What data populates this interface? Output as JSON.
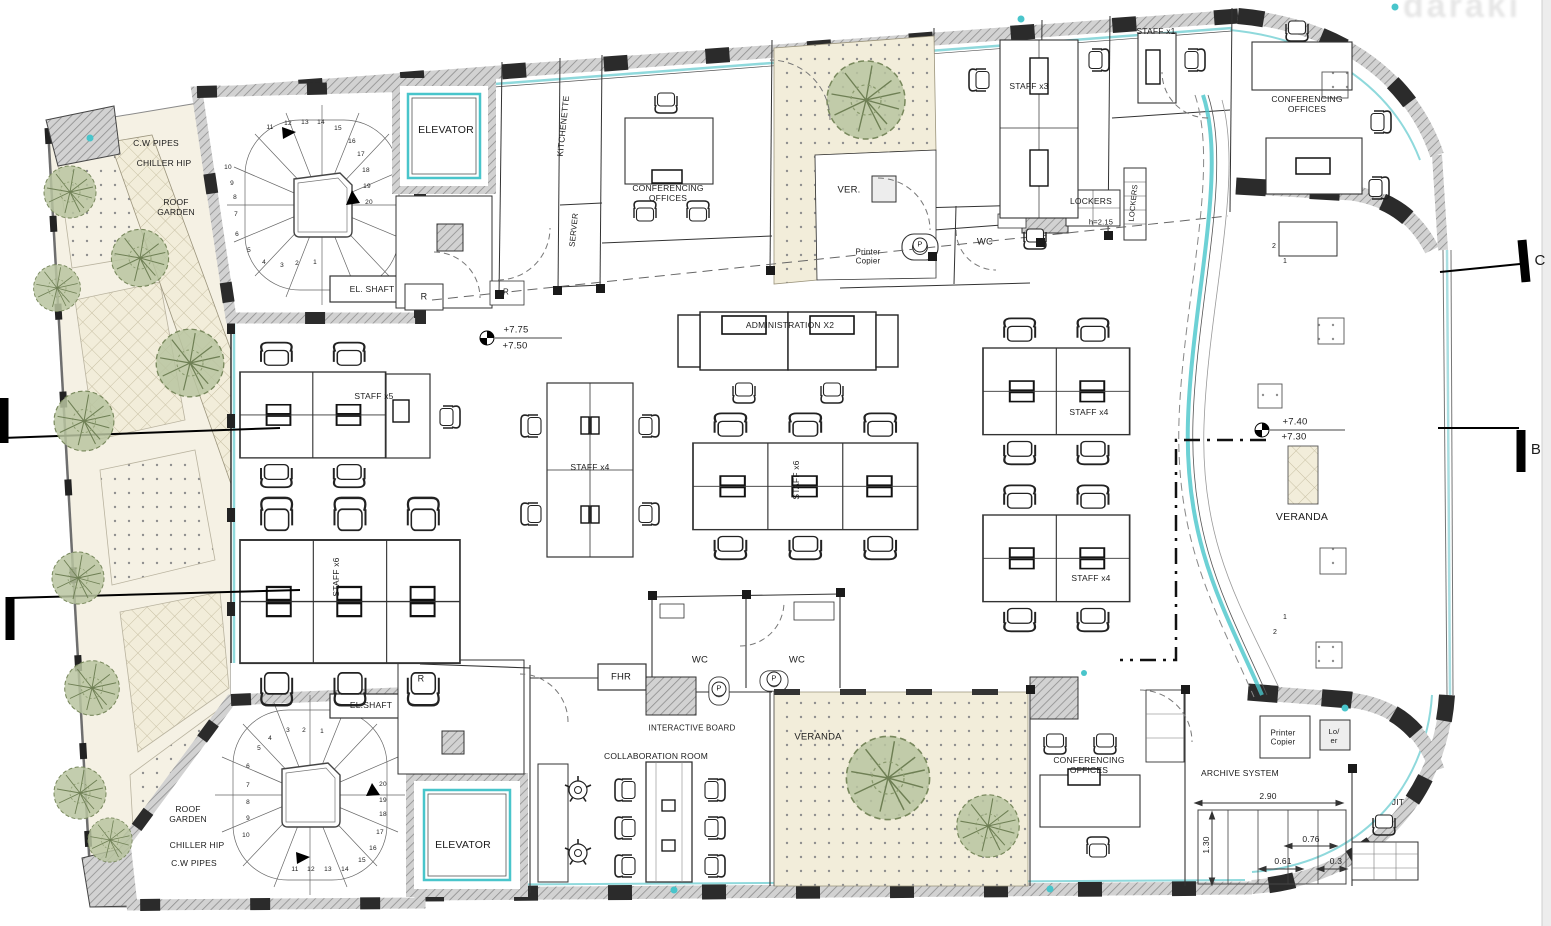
{
  "drawing": {
    "type": "office-floor-plan",
    "section_markers": [
      "C",
      "B"
    ],
    "stair_step_count": 20,
    "colors": {
      "wall_gray": "#d2d2d2",
      "hatch_line": "#8e8e8e",
      "line_black": "#2a2a2a",
      "glazing_cyan": "#8fd9dc",
      "accent_teal": "#49c5cb",
      "tree_green": "#b9c4a0",
      "garden_cream": "#f2edda"
    },
    "watermark_fragment": "daraki"
  },
  "labels": [
    {
      "name": "cw-pipes-top-label",
      "text": "C.W PIPES",
      "x": 156,
      "y": 143,
      "fs": 8.5
    },
    {
      "name": "chiller-hip-top-label",
      "text": "CHILLER HIP",
      "x": 164,
      "y": 163,
      "fs": 8.5
    },
    {
      "name": "roof-garden-top-label",
      "text": "ROOF\nGARDEN",
      "x": 176,
      "y": 207,
      "fs": 8.5
    },
    {
      "name": "el-shaft-top-label",
      "text": "EL. SHAFT",
      "x": 372,
      "y": 289,
      "fs": 8.5
    },
    {
      "name": "r-closet-top-1-label",
      "text": "R",
      "x": 424,
      "y": 297,
      "fs": 9
    },
    {
      "name": "r-closet-top-2-label",
      "text": "R",
      "x": 506,
      "y": 292,
      "fs": 8
    },
    {
      "name": "elevator-top-label",
      "text": "ELEVATOR",
      "x": 446,
      "y": 130,
      "fs": 10.5
    },
    {
      "name": "kitchenette-label",
      "text": "KITCHENETTE",
      "x": 563,
      "y": 126,
      "fs": 8.5,
      "rot": -84
    },
    {
      "name": "server-label",
      "text": "SERVER",
      "x": 574,
      "y": 230,
      "fs": 8,
      "rot": -84
    },
    {
      "name": "conferencing-offices-top-label",
      "text": "CONFERENCING\nOFFICES",
      "x": 668,
      "y": 193,
      "fs": 8.5
    },
    {
      "name": "ver-label",
      "text": "VER.",
      "x": 849,
      "y": 190,
      "fs": 9.5
    },
    {
      "name": "printer-copier-top-label",
      "text": "Printer\nCopier",
      "x": 868,
      "y": 257,
      "fs": 8
    },
    {
      "name": "printer-p-top-label",
      "text": "P",
      "x": 920,
      "y": 245,
      "fs": 7.5,
      "cls": "circ"
    },
    {
      "name": "wc-top-label",
      "text": "WC",
      "x": 985,
      "y": 242,
      "fs": 9.5
    },
    {
      "name": "staff-x3-label",
      "text": "STAFF x3",
      "x": 1029,
      "y": 86,
      "fs": 8.5
    },
    {
      "name": "lockers-label",
      "text": "LOCKERS",
      "x": 1091,
      "y": 201,
      "fs": 8.5
    },
    {
      "name": "lockers-height-label",
      "text": "h=2.15",
      "x": 1101,
      "y": 223,
      "fs": 7.5
    },
    {
      "name": "lockers-vertical-label",
      "text": "LOCKERS",
      "x": 1134,
      "y": 203,
      "fs": 7.5,
      "rot": -84
    },
    {
      "name": "staff-x1-label",
      "text": "STAFF x1",
      "x": 1156,
      "y": 31,
      "fs": 8.5
    },
    {
      "name": "conferencing-offices-topright-label",
      "text": "CONFERENCING\nOFFICES",
      "x": 1307,
      "y": 104,
      "fs": 8.5
    },
    {
      "name": "level-775-label",
      "text": "+7.75",
      "x": 516,
      "y": 330,
      "fs": 9.5
    },
    {
      "name": "level-750-label",
      "text": "+7.50",
      "x": 515,
      "y": 346,
      "fs": 9.5
    },
    {
      "name": "administration-x2-label",
      "text": "ADMINISTRATION X2",
      "x": 790,
      "y": 325,
      "fs": 8.5
    },
    {
      "name": "staff-x5-label",
      "text": "STAFF x5",
      "x": 374,
      "y": 396,
      "fs": 8.5
    },
    {
      "name": "staff-x4-centerleft-label",
      "text": "STAFF x4",
      "x": 590,
      "y": 467,
      "fs": 8.5
    },
    {
      "name": "staff-x6-left-label",
      "text": "STAFF x6",
      "x": 336,
      "y": 577,
      "fs": 8.5,
      "rot": -90
    },
    {
      "name": "staff-x6-center-label",
      "text": "STAFF x6",
      "x": 796,
      "y": 480,
      "fs": 8.5,
      "rot": -90
    },
    {
      "name": "staff-x4-right-upper-label",
      "text": "STAFF x4",
      "x": 1089,
      "y": 412,
      "fs": 8.5
    },
    {
      "name": "staff-x4-right-lower-label",
      "text": "STAFF x4",
      "x": 1091,
      "y": 578,
      "fs": 8.5
    },
    {
      "name": "level-740-label",
      "text": "+7.40",
      "x": 1295,
      "y": 422,
      "fs": 9.5
    },
    {
      "name": "level-730-label",
      "text": "+7.30",
      "x": 1294,
      "y": 437,
      "fs": 9.5
    },
    {
      "name": "veranda-right-label",
      "text": "VERANDA",
      "x": 1302,
      "y": 517,
      "fs": 10.5
    },
    {
      "name": "step-2-top-label",
      "text": "2",
      "x": 1274,
      "y": 247,
      "fs": 7
    },
    {
      "name": "step-1-top-label",
      "text": "1",
      "x": 1285,
      "y": 262,
      "fs": 7
    },
    {
      "name": "step-1-bottom-label",
      "text": "1",
      "x": 1285,
      "y": 618,
      "fs": 7
    },
    {
      "name": "step-2-bottom-label",
      "text": "2",
      "x": 1275,
      "y": 633,
      "fs": 7
    },
    {
      "name": "r-closet-bottom-label",
      "text": "R",
      "x": 421,
      "y": 679,
      "fs": 9
    },
    {
      "name": "fhr-label",
      "text": "FHR",
      "x": 621,
      "y": 677,
      "fs": 9.5
    },
    {
      "name": "wc-bottom-1-label",
      "text": "WC",
      "x": 700,
      "y": 660,
      "fs": 9.5
    },
    {
      "name": "wc-bottom-2-label",
      "text": "WC",
      "x": 797,
      "y": 660,
      "fs": 9.5
    },
    {
      "name": "printer-p-bottom-1-label",
      "text": "P",
      "x": 719,
      "y": 689,
      "fs": 7.5,
      "cls": "circ"
    },
    {
      "name": "printer-p-bottom-2-label",
      "text": "P",
      "x": 774,
      "y": 679,
      "fs": 7.5,
      "cls": "circ"
    },
    {
      "name": "interactive-board-label",
      "text": "INTERACTIVE BOARD",
      "x": 692,
      "y": 728,
      "fs": 8
    },
    {
      "name": "el-shaft-bottom-label",
      "text": "EL.SHAFT",
      "x": 371,
      "y": 705,
      "fs": 8.5
    },
    {
      "name": "collaboration-room-label",
      "text": "COLLABORATION ROOM",
      "x": 656,
      "y": 756,
      "fs": 8.5
    },
    {
      "name": "veranda-bottom-label",
      "text": "VERANDA",
      "x": 818,
      "y": 737,
      "fs": 9.5
    },
    {
      "name": "roof-garden-bottom-label",
      "text": "ROOF\nGARDEN",
      "x": 188,
      "y": 814,
      "fs": 8.5
    },
    {
      "name": "chiller-hip-bottom-label",
      "text": "CHILLER HIP",
      "x": 197,
      "y": 845,
      "fs": 8.5
    },
    {
      "name": "cw-pipes-bottom-label",
      "text": "C.W PIPES",
      "x": 194,
      "y": 863,
      "fs": 8.5
    },
    {
      "name": "elevator-bottom-label",
      "text": "ELEVATOR",
      "x": 463,
      "y": 845,
      "fs": 10.5
    },
    {
      "name": "conferencing-offices-bottom-label",
      "text": "CONFERENCING\nOFFICES",
      "x": 1089,
      "y": 765,
      "fs": 8.5
    },
    {
      "name": "printer-copier-bottom-label",
      "text": "Printer\nCopier",
      "x": 1283,
      "y": 738,
      "fs": 8
    },
    {
      "name": "loer-label",
      "text": "Lo/\ner",
      "x": 1334,
      "y": 737,
      "fs": 7.5
    },
    {
      "name": "archive-system-label",
      "text": "ARCHIVE SYSTEM",
      "x": 1240,
      "y": 773,
      "fs": 8.5
    },
    {
      "name": "dim-290-label",
      "text": "2.90",
      "x": 1268,
      "y": 796,
      "fs": 8.5
    },
    {
      "name": "dim-130-label",
      "text": "1.30",
      "x": 1206,
      "y": 845,
      "fs": 8.5,
      "rot": -90
    },
    {
      "name": "dim-076-label",
      "text": "0.76",
      "x": 1311,
      "y": 839,
      "fs": 8.5
    },
    {
      "name": "dim-061-label",
      "text": "0.61",
      "x": 1283,
      "y": 861,
      "fs": 8.5
    },
    {
      "name": "dim-03-label",
      "text": "0.3",
      "x": 1336,
      "y": 861,
      "fs": 8.5
    },
    {
      "name": "jit-label",
      "text": "JIT",
      "x": 1398,
      "y": 802,
      "fs": 8.5
    },
    {
      "name": "section-c-label",
      "text": "C",
      "x": 1540,
      "y": 261,
      "fs": 15,
      "cls": "sec"
    },
    {
      "name": "section-b-label",
      "text": "B",
      "x": 1536,
      "y": 450,
      "fs": 15,
      "cls": "sec"
    },
    {
      "name": "watermark-fragment",
      "text": "daraki",
      "x": 1462,
      "y": 6,
      "fs": 34,
      "cls": "wm"
    },
    {
      "name": "stair-top-num",
      "text": "11",
      "x": 270,
      "y": 128,
      "fs": 6.5
    },
    {
      "name": "stair-top-num",
      "text": "12",
      "x": 288,
      "y": 124,
      "fs": 6.5
    },
    {
      "name": "stair-top-num",
      "text": "13",
      "x": 305,
      "y": 123,
      "fs": 6.5
    },
    {
      "name": "stair-top-num",
      "text": "14",
      "x": 321,
      "y": 123,
      "fs": 6.5
    },
    {
      "name": "stair-top-num",
      "text": "15",
      "x": 338,
      "y": 129,
      "fs": 6.5
    },
    {
      "name": "stair-top-num",
      "text": "16",
      "x": 352,
      "y": 142,
      "fs": 6.5
    },
    {
      "name": "stair-top-num",
      "text": "17",
      "x": 361,
      "y": 155,
      "fs": 6.5
    },
    {
      "name": "stair-top-num",
      "text": "18",
      "x": 366,
      "y": 171,
      "fs": 6.5
    },
    {
      "name": "stair-top-num",
      "text": "19",
      "x": 367,
      "y": 187,
      "fs": 6.5
    },
    {
      "name": "stair-top-num",
      "text": "20",
      "x": 369,
      "y": 203,
      "fs": 6.5
    },
    {
      "name": "stair-top-num",
      "text": "10",
      "x": 228,
      "y": 168,
      "fs": 6.5
    },
    {
      "name": "stair-top-num",
      "text": "9",
      "x": 232,
      "y": 184,
      "fs": 6.5
    },
    {
      "name": "stair-top-num",
      "text": "8",
      "x": 235,
      "y": 198,
      "fs": 6.5
    },
    {
      "name": "stair-top-num",
      "text": "7",
      "x": 236,
      "y": 215,
      "fs": 6.5
    },
    {
      "name": "stair-top-num",
      "text": "6",
      "x": 237,
      "y": 235,
      "fs": 6.5
    },
    {
      "name": "stair-top-num",
      "text": "5",
      "x": 249,
      "y": 251,
      "fs": 6.5
    },
    {
      "name": "stair-top-num",
      "text": "4",
      "x": 264,
      "y": 263,
      "fs": 6.5
    },
    {
      "name": "stair-top-num",
      "text": "3",
      "x": 282,
      "y": 266,
      "fs": 6.5
    },
    {
      "name": "stair-top-num",
      "text": "2",
      "x": 297,
      "y": 264,
      "fs": 6.5
    },
    {
      "name": "stair-top-num",
      "text": "1",
      "x": 315,
      "y": 263,
      "fs": 6.5
    },
    {
      "name": "stair-bottom-num",
      "text": "1",
      "x": 322,
      "y": 732,
      "fs": 6.5
    },
    {
      "name": "stair-bottom-num",
      "text": "2",
      "x": 304,
      "y": 731,
      "fs": 6.5
    },
    {
      "name": "stair-bottom-num",
      "text": "3",
      "x": 288,
      "y": 731,
      "fs": 6.5
    },
    {
      "name": "stair-bottom-num",
      "text": "4",
      "x": 270,
      "y": 739,
      "fs": 6.5
    },
    {
      "name": "stair-bottom-num",
      "text": "5",
      "x": 259,
      "y": 749,
      "fs": 6.5
    },
    {
      "name": "stair-bottom-num",
      "text": "6",
      "x": 248,
      "y": 767,
      "fs": 6.5
    },
    {
      "name": "stair-bottom-num",
      "text": "7",
      "x": 248,
      "y": 786,
      "fs": 6.5
    },
    {
      "name": "stair-bottom-num",
      "text": "8",
      "x": 248,
      "y": 803,
      "fs": 6.5
    },
    {
      "name": "stair-bottom-num",
      "text": "9",
      "x": 248,
      "y": 819,
      "fs": 6.5
    },
    {
      "name": "stair-bottom-num",
      "text": "10",
      "x": 246,
      "y": 836,
      "fs": 6.5
    },
    {
      "name": "stair-bottom-num",
      "text": "11",
      "x": 295,
      "y": 870,
      "fs": 6.5
    },
    {
      "name": "stair-bottom-num",
      "text": "12",
      "x": 311,
      "y": 870,
      "fs": 6.5
    },
    {
      "name": "stair-bottom-num",
      "text": "13",
      "x": 328,
      "y": 870,
      "fs": 6.5
    },
    {
      "name": "stair-bottom-num",
      "text": "14",
      "x": 345,
      "y": 870,
      "fs": 6.5
    },
    {
      "name": "stair-bottom-num",
      "text": "15",
      "x": 362,
      "y": 861,
      "fs": 6.5
    },
    {
      "name": "stair-bottom-num",
      "text": "16",
      "x": 373,
      "y": 849,
      "fs": 6.5
    },
    {
      "name": "stair-bottom-num",
      "text": "17",
      "x": 380,
      "y": 833,
      "fs": 6.5
    },
    {
      "name": "stair-bottom-num",
      "text": "18",
      "x": 383,
      "y": 815,
      "fs": 6.5
    },
    {
      "name": "stair-bottom-num",
      "text": "19",
      "x": 383,
      "y": 801,
      "fs": 6.5
    },
    {
      "name": "stair-bottom-num",
      "text": "20",
      "x": 383,
      "y": 785,
      "fs": 6.5
    }
  ]
}
